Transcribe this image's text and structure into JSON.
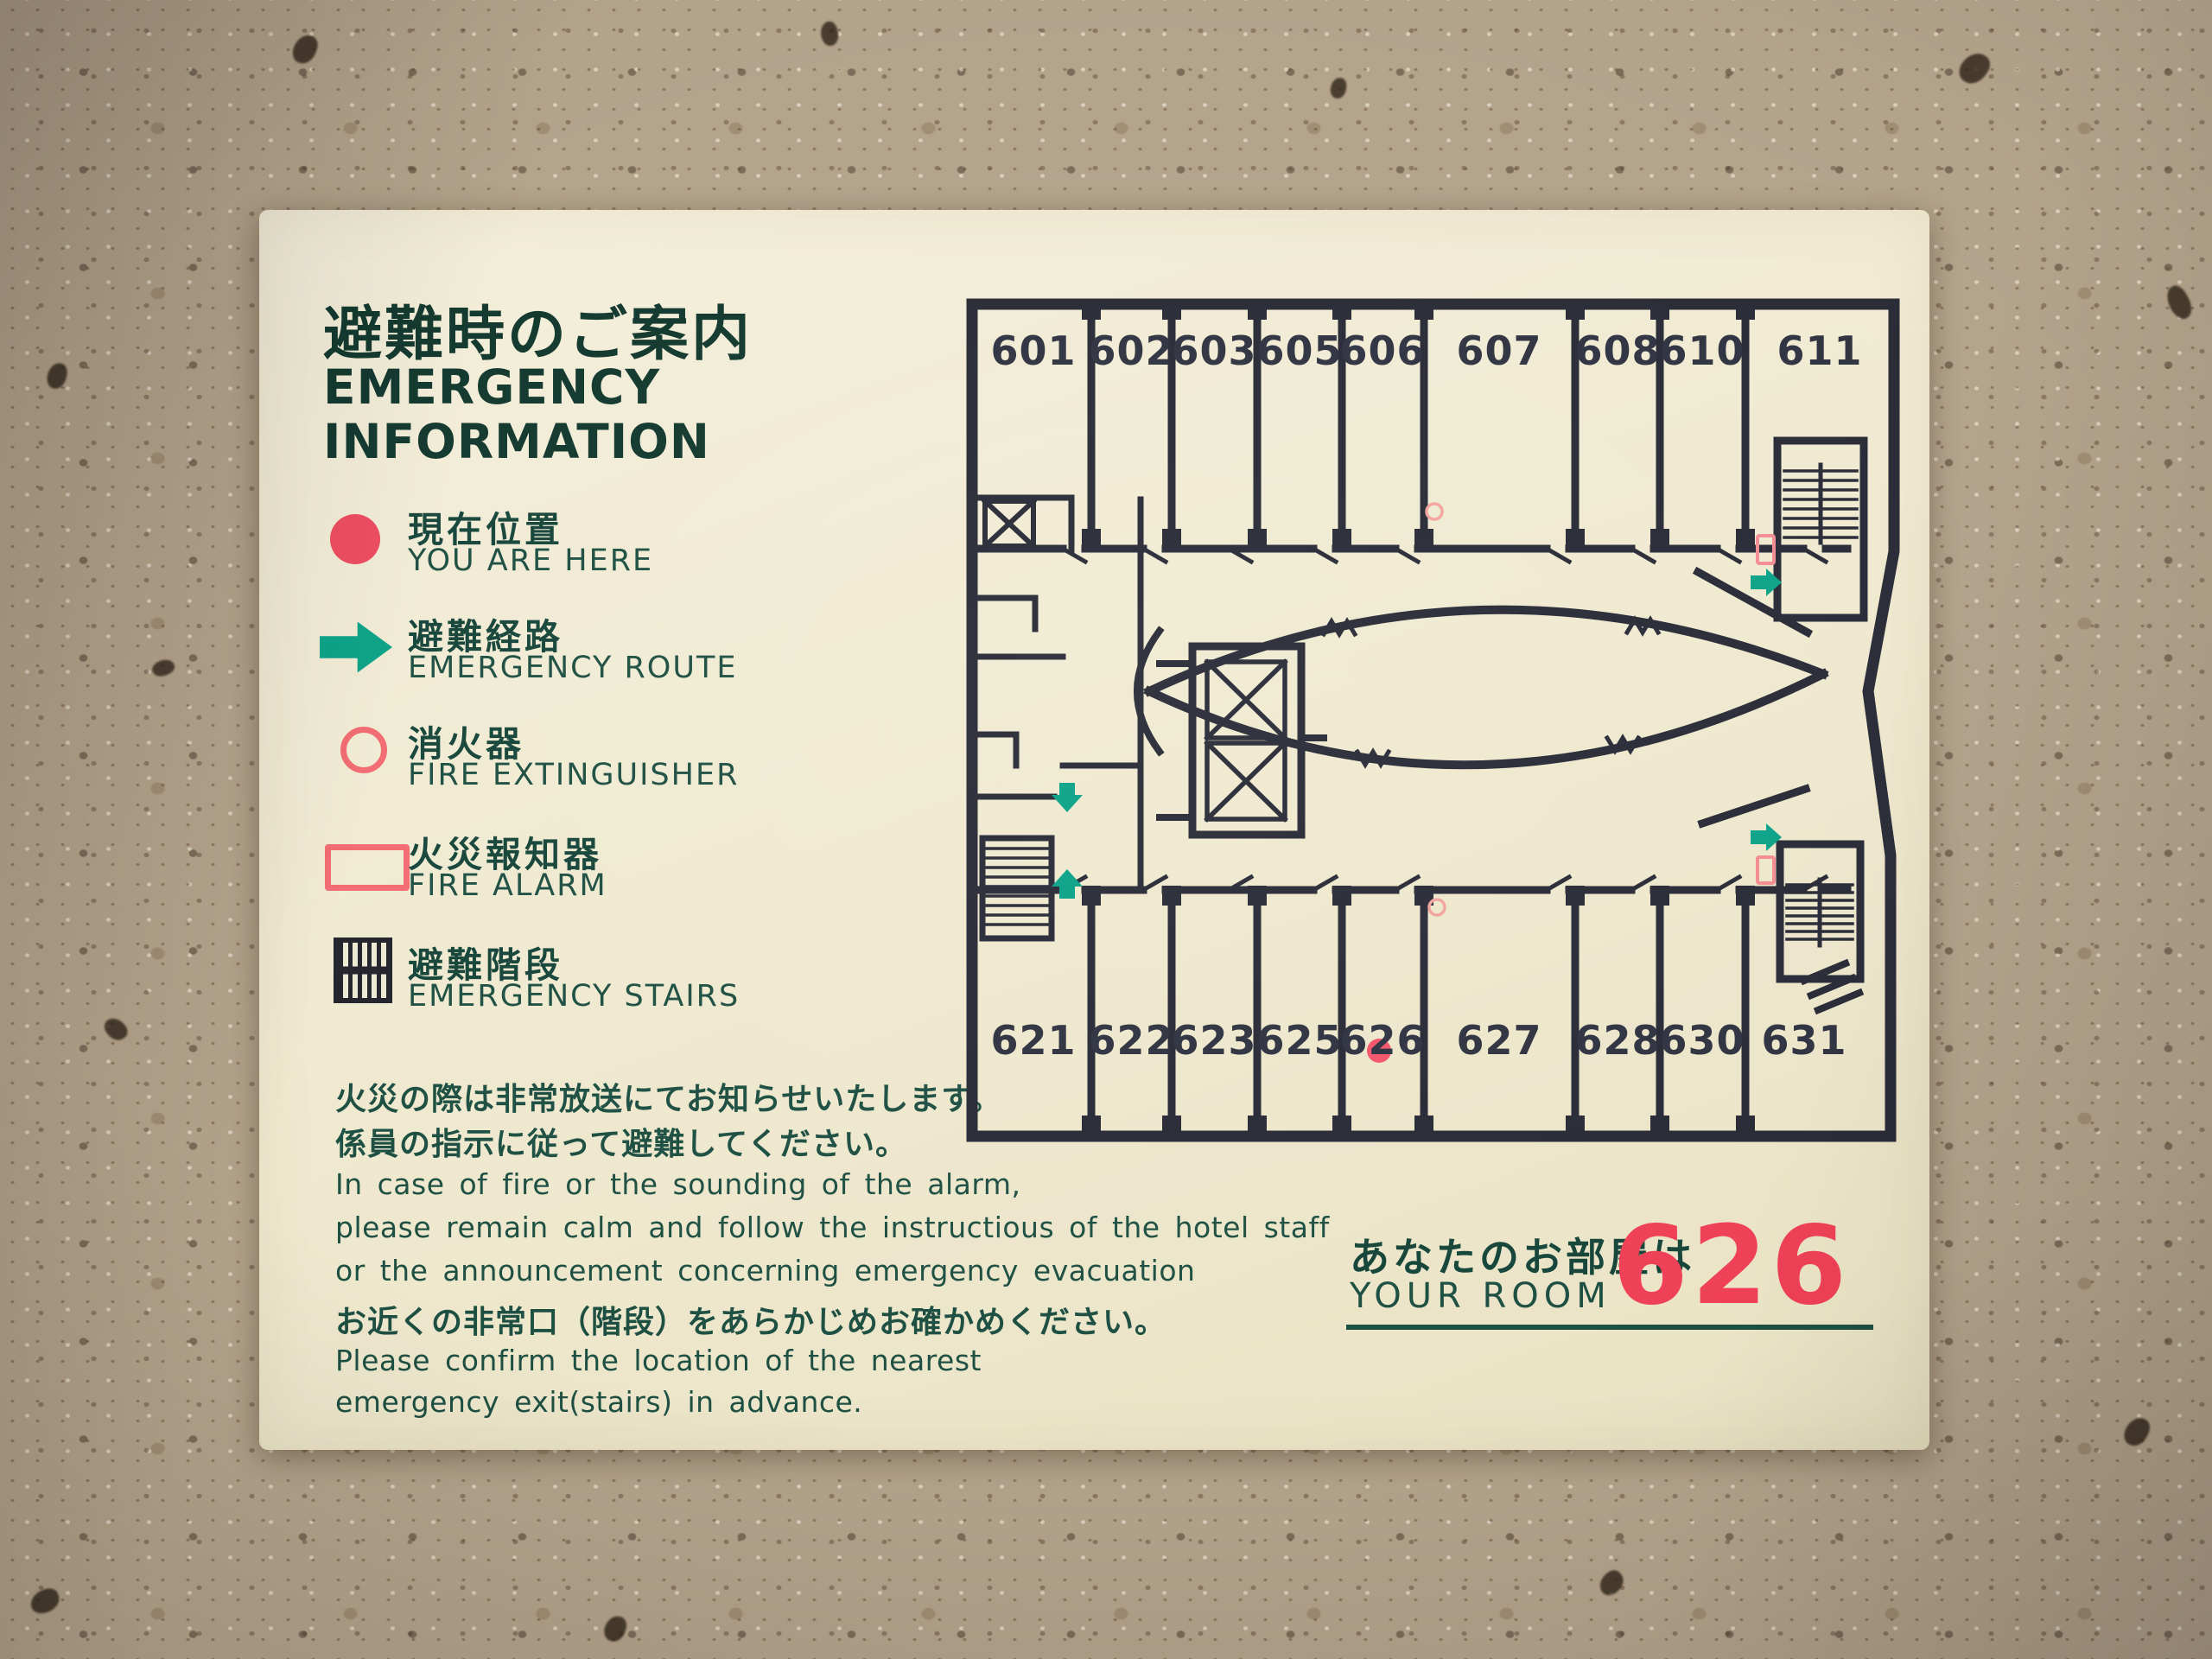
{
  "sign": {
    "title_jp": "避難時のご案内",
    "title_en_line1": "EMERGENCY",
    "title_en_line2": "INFORMATION",
    "legend": [
      {
        "symbol": "you-are-here-dot",
        "jp": "現在位置",
        "en": "YOU ARE HERE"
      },
      {
        "symbol": "emergency-route-arrow",
        "jp": "避難経路",
        "en": "EMERGENCY ROUTE"
      },
      {
        "symbol": "fire-extinguisher-circle",
        "jp": "消火器",
        "en": "FIRE EXTINGUISHER"
      },
      {
        "symbol": "fire-alarm-rect",
        "jp": "火災報知器",
        "en": "FIRE ALARM"
      },
      {
        "symbol": "emergency-stairs-hatch",
        "jp": "避難階段",
        "en": "EMERGENCY STAIRS"
      }
    ],
    "notice": {
      "jp_line1": "火災の際は非常放送にてお知らせいたします。",
      "jp_line2": "係員の指示に従って避難してください。",
      "en_line1": "In case of fire or the sounding of the alarm,",
      "en_line2": "please remain calm and follow the instructious of the hotel staff",
      "en_line3": "or the announcement concerning emergency evacuation",
      "jp_line3": "お近くの非常口（階段）をあらかじめお確かめください。",
      "en_line4": "Please confirm the location of the nearest",
      "en_line5": "emergency exit(stairs) in advance."
    },
    "your_room": {
      "jp": "あなたのお部屋は",
      "en": "YOUR ROOM",
      "number": "626"
    },
    "floor_plan": {
      "top_rooms": [
        "601",
        "602",
        "603",
        "605",
        "606",
        "607",
        "608",
        "610",
        "611"
      ],
      "bottom_rooms": [
        "621",
        "622",
        "623",
        "625",
        "626",
        "627",
        "628",
        "630",
        "631"
      ],
      "you_are_here_room": "626",
      "markers": {
        "you_are_here": "red dot in room 626",
        "emergency_routes": "teal arrows near left service stairs and near right stairwells by rooms 611 and 631",
        "fire_extinguishers": "red circles on upper and lower corridors",
        "fire_alarms": "red rectangles beside right stairwells",
        "emergency_stairs": "hatched stairwells at left service area and right ends near 611 and 631",
        "elevators": "two crossed-box elevator shafts at center, one service elevator at upper left"
      }
    },
    "colors": {
      "accent_red": "#ef4056",
      "route_teal": "#0aa287",
      "symbol_red": "#f26b72",
      "text_green": "#1d4f42",
      "wall_dark": "#282a36",
      "sign_background": "#f1ecd6"
    }
  }
}
